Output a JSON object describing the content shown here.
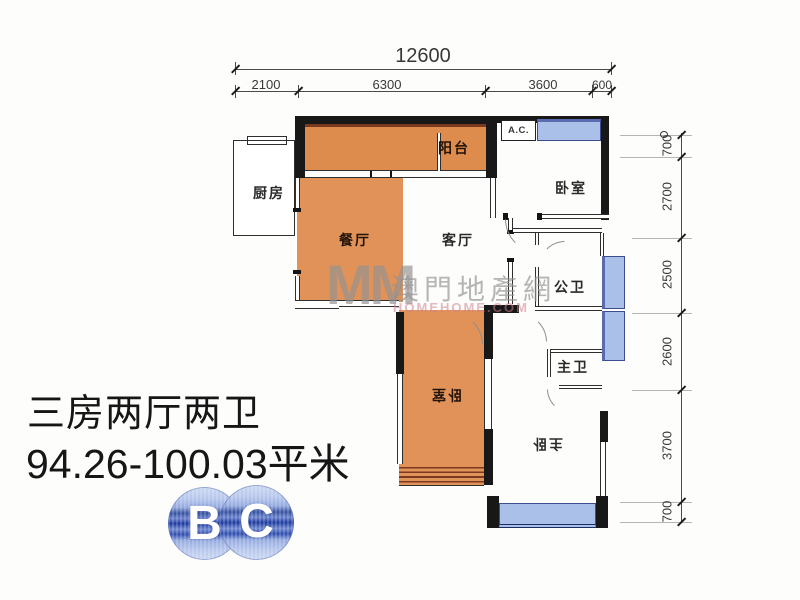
{
  "dimensions": {
    "top": {
      "total": "12600",
      "segments": [
        "2100",
        "6300",
        "3600",
        "600"
      ]
    },
    "right": {
      "segments": [
        "700",
        "2700",
        "2500",
        "2600",
        "3700",
        "700"
      ]
    }
  },
  "rooms": {
    "kitchen": "厨房",
    "balcony": "阳台",
    "dining": "餐厅",
    "living": "客厅",
    "bedroom_top": "卧室",
    "public_bath": "公卫",
    "bedroom_mid": "卧室",
    "master_bath": "主卫",
    "master_bedroom": "主卧",
    "ac_unit": "A.C."
  },
  "watermark": {
    "logo": "MM",
    "site_name": "澳門地產網",
    "site_url": "HOMEHOME.COM"
  },
  "summary": {
    "layout_type": "三房两厅两卫",
    "area_range": "94.26-100.03平米"
  },
  "block_logo": {
    "letter_b": "B",
    "letter_c": "C"
  },
  "colors": {
    "room_fill": "#e09258",
    "balcony_fill": "#de8c4e",
    "window_fill": "#abc0e8",
    "wall": "#181818",
    "logo_blue": "#2e4cae",
    "watermark_gray": "#949292"
  }
}
